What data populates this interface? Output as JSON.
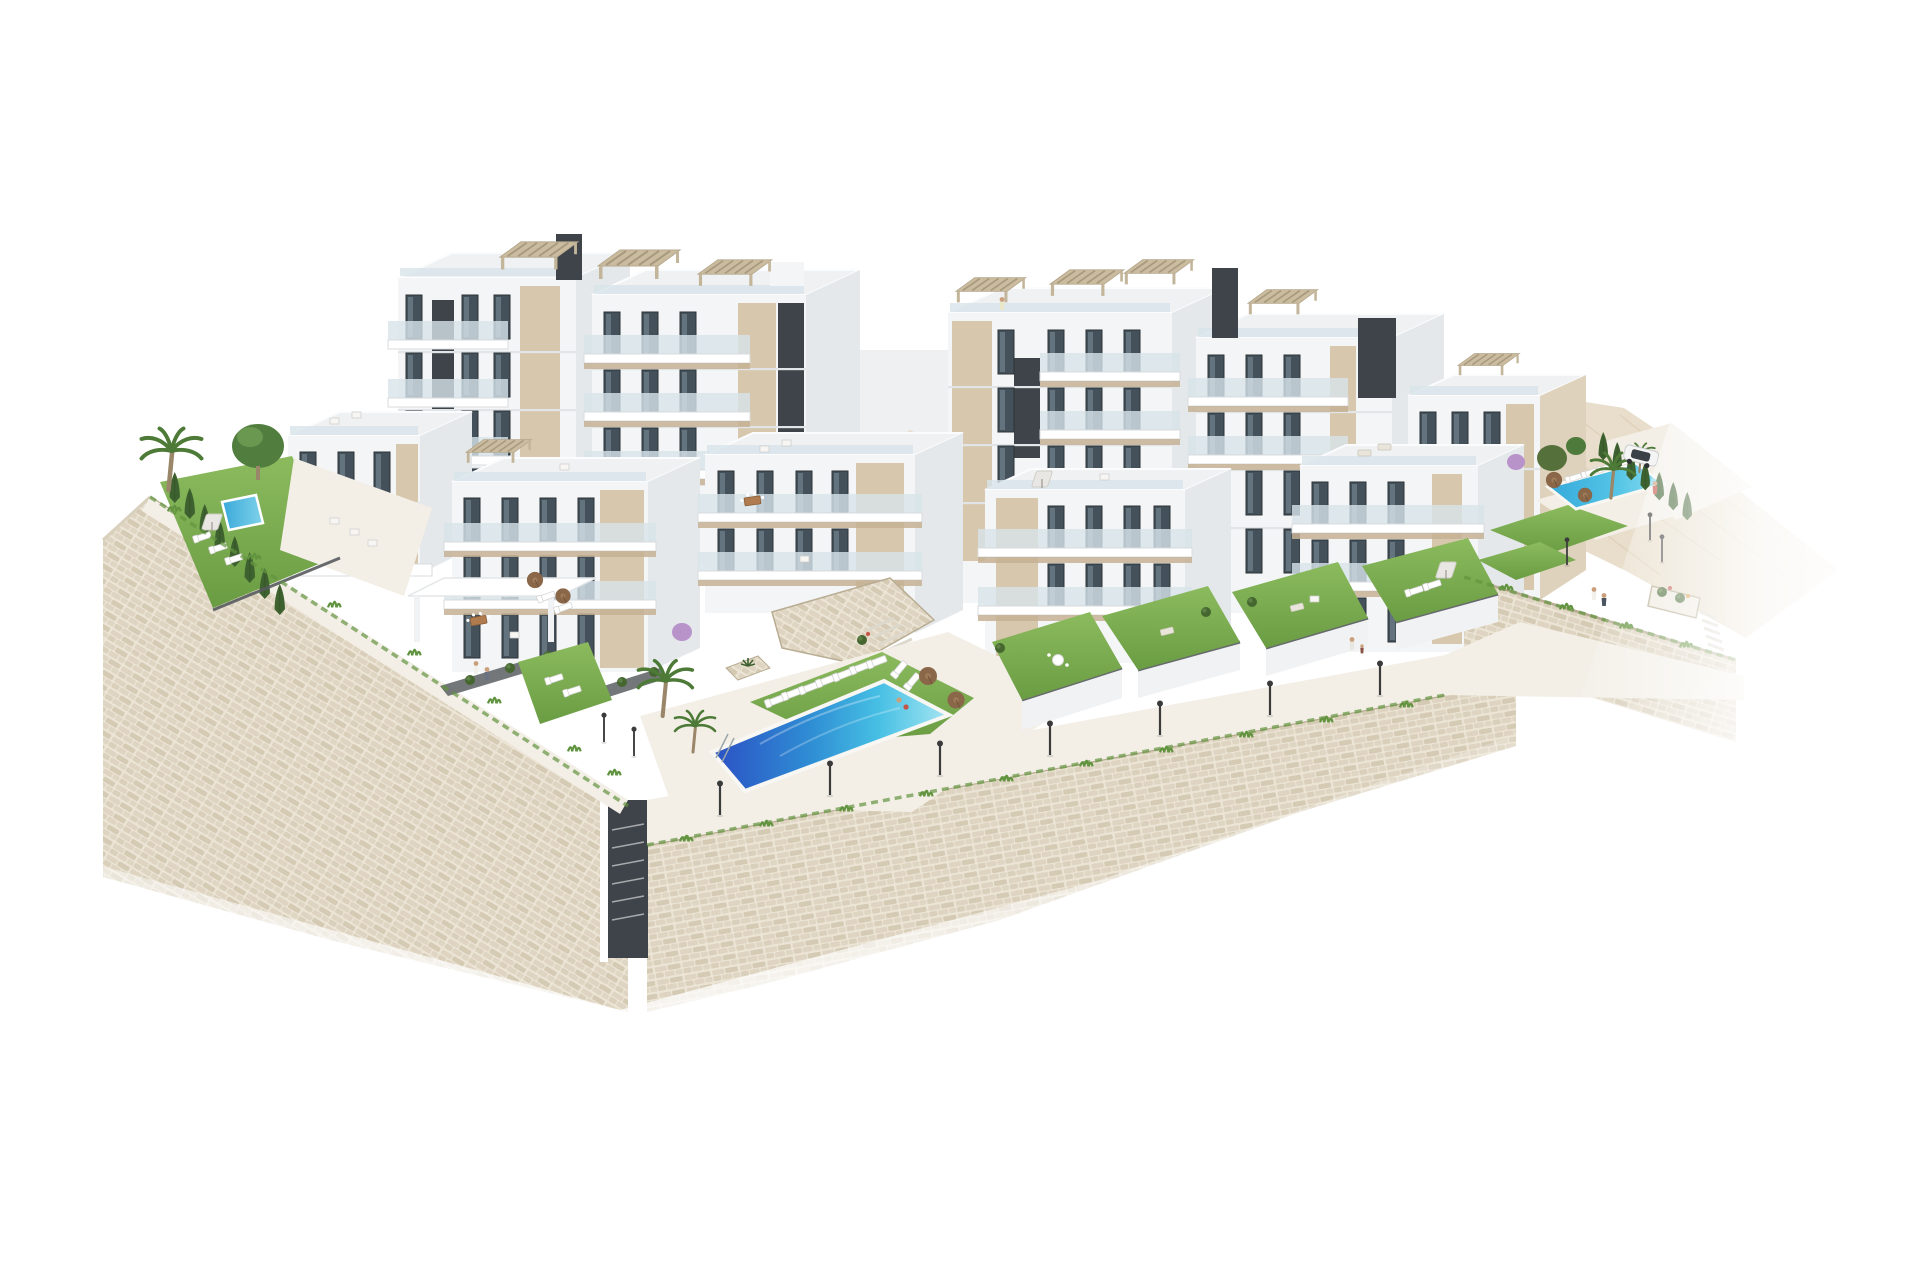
{
  "scene": {
    "title": "Aerial 3D architectural render of a hillside apartment complex with pools and stone retaining walls",
    "description": "Photorealistic CGI rendering on a pure white background. A terraced residential development of modern white apartment blocks with beige accent panels, dark stair cores, glass balustrade terraces and slatted roof pergolas steps down a slope. Landscaped grounds include a large two-tone community swimming pool with sun loungers and brown parasols, a private garden pool on the left, a third pool on the right beside a parked white car, green lawns, cypress hedges, palm trees, street lamps and tiny people. The whole site sits on tall beige stone retaining walls that fade to white at the bottom of the image.",
    "style": "photorealistic CGI, isolated on white",
    "view": "aerial three-quarter view from the south"
  },
  "palette": {
    "background": "#ffffff",
    "facade": "#f4f5f6",
    "facade_shade": "#e5e8ea",
    "roof": "#eff1f2",
    "core": "#3e4449",
    "window": "#44505a",
    "window_frame": "#2c3338",
    "beige": "#d7c7ac",
    "beige_dark": "#c6b294",
    "pergola": "#cbbc9f",
    "balustrade": "#d7e4ea",
    "stone_light": "#ece5d6",
    "stone_mid": "#ded4c1",
    "stone_dark": "#cfc3ab",
    "stone_line": "#b8ac93",
    "paving": "#eae5da",
    "paving_light": "#f3efe7",
    "grass": "#7fb054",
    "grass_dark": "#62943f",
    "hedge": "#45662f",
    "cypress": "#3e6130",
    "palm": "#4d7a37",
    "trunk": "#9a8668",
    "pool_deep": "#2b50c4",
    "pool_mid": "#2f9ed8",
    "pool_light": "#7fd4ea",
    "umbrella": "#8a6748",
    "hill": "#e8decb",
    "lamp": "#3b3b3b",
    "car_body": "#f4f4f4",
    "car_glass": "#3a4248",
    "flower_red": "#c65548",
    "flower_purple": "#b793c9"
  },
  "elements": {
    "buildings": {
      "count": 10,
      "floors": "2-5",
      "features": [
        "slatted roof pergolas",
        "glass balustrade terraces",
        "beige accent panels",
        "dark stair cores",
        "roof terraces with furniture"
      ]
    },
    "pools": [
      {
        "name": "main community pool",
        "tones": [
          "deep blue",
          "turquoise"
        ],
        "position": "bottom centre"
      },
      {
        "name": "private garden pool",
        "tones": [
          "azure"
        ],
        "position": "left garden"
      },
      {
        "name": "secondary pool",
        "tones": [
          "turquoise"
        ],
        "position": "right garden"
      }
    ],
    "vehicles": [
      {
        "name": "white car",
        "position": "driveway top right"
      }
    ],
    "landscape": [
      "beige stone retaining walls",
      "terraced lawns",
      "cypress hedges",
      "palm trees",
      "street lamps",
      "sun loungers",
      "brown parasols",
      "flower planters",
      "tiny people",
      "grass tufts along wall edges"
    ]
  }
}
